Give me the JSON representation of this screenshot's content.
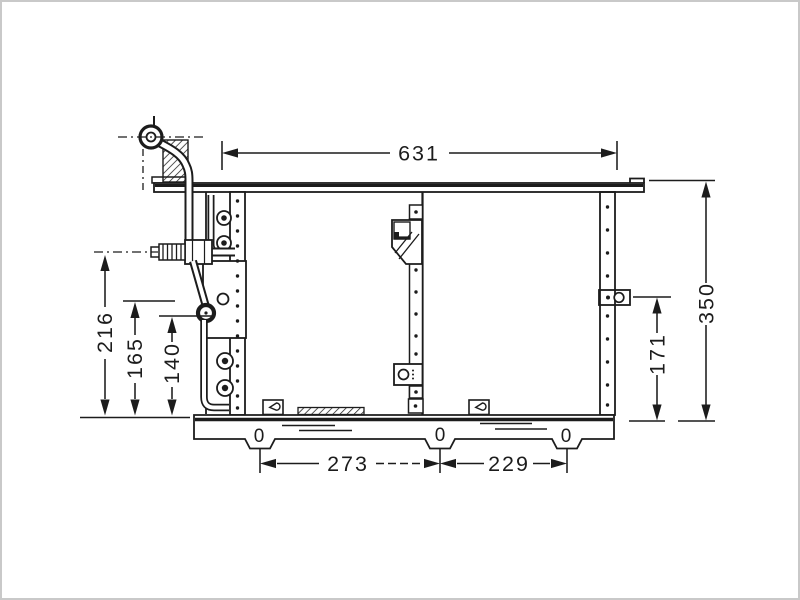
{
  "page": {
    "background": "#ffffff",
    "frame_border": "#c9c9c9",
    "ink_color": "#1c1c1c"
  },
  "drawing": {
    "dimensions": {
      "top_width": "631",
      "overall_height": "350",
      "right_mount_height": "171",
      "left_port_height": "216",
      "left_mid_height": "165",
      "left_lower_height": "140",
      "bottom_left_span": "273",
      "bottom_right_span": "229"
    },
    "datum_marks": [
      "0",
      "0",
      "0"
    ]
  }
}
